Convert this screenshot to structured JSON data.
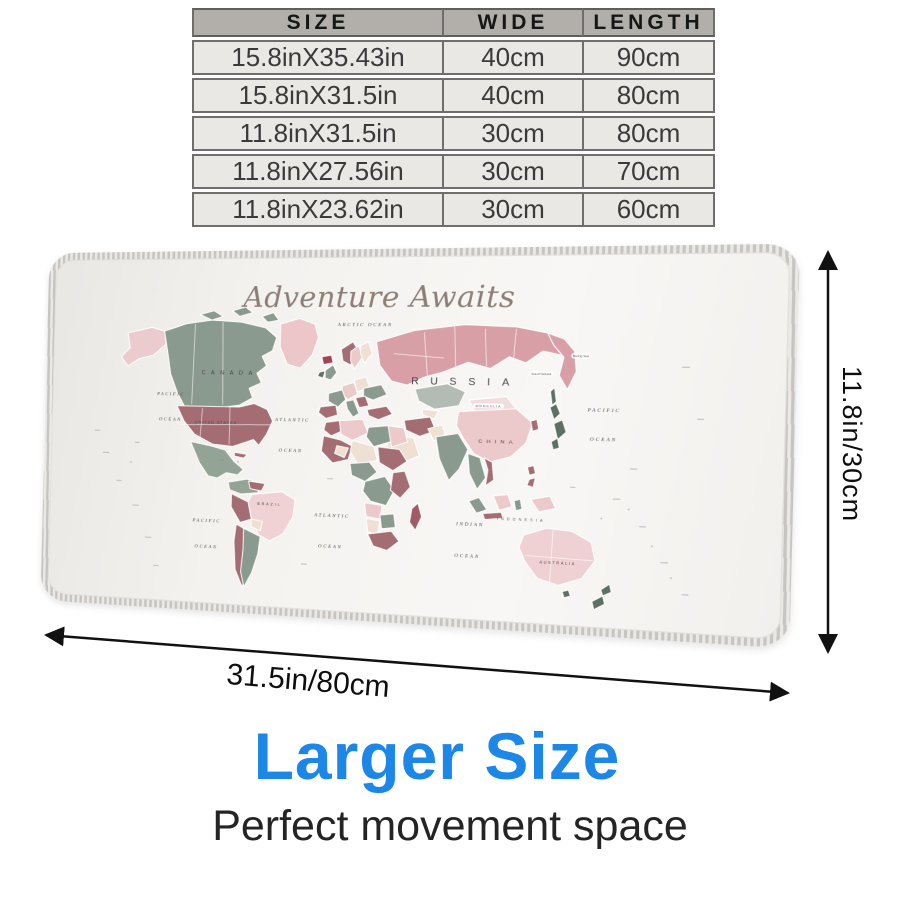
{
  "table": {
    "headers": [
      "SIZE",
      "WIDE",
      "LENGTH"
    ],
    "rows": [
      [
        "15.8inX35.43in",
        "40cm",
        "90cm"
      ],
      [
        "15.8inX31.5in",
        "40cm",
        "80cm"
      ],
      [
        "11.8inX31.5in",
        "30cm",
        "80cm"
      ],
      [
        "11.8inX27.56in",
        "30cm",
        "70cm"
      ],
      [
        "11.8inX23.62in",
        "30cm",
        "60cm"
      ]
    ]
  },
  "pad": {
    "script_title": "Adventure Awaits",
    "labels": {
      "arctic": "ARCTIC OCEAN",
      "pacific_nw_line1": "PACIFIC",
      "pacific_nw_line2": "OCEAN",
      "pacific_sw_line1": "PACIFIC",
      "pacific_sw_line2": "OCEAN",
      "atlantic_n_line1": "ATLANTIC",
      "atlantic_n_line2": "OCEAN",
      "atlantic_s_line1": "ATLANTIC",
      "atlantic_s_line2": "OCEAN",
      "indian_line1": "INDIAN",
      "indian_line2": "OCEAN",
      "pacific_e_line1": "PACIFIC",
      "pacific_e_line2": "OCEAN",
      "russia": "RUSSIA",
      "canada": "CANADA",
      "united_states": "UNITED STATES",
      "china": "CHINA",
      "mongolia": "MONGOLIA",
      "brazil": "BRAZIL",
      "australia": "AUSTRALIA",
      "indonesia": "INDONESIA",
      "bering_sea": "Bering Sea",
      "sea_of_okhotsk": "Sea of Okhotsk"
    }
  },
  "dimensions": {
    "height": "11.8in/30cm",
    "width": "31.5in/80cm"
  },
  "footer": {
    "headline": "Larger Size",
    "subheadline": "Perfect movement space"
  },
  "colors": {
    "headline_blue": "#1d87e8",
    "table_header_gray": "#b2afaa",
    "table_row_gray": "#eae8e5",
    "map_rose": "#d8a0a6",
    "map_pink_light": "#ecc9cb",
    "map_sage": "#8a9a8e",
    "map_mauve": "#a46d74",
    "map_cream": "#eee0d2",
    "map_dark_green": "#5d7064"
  }
}
